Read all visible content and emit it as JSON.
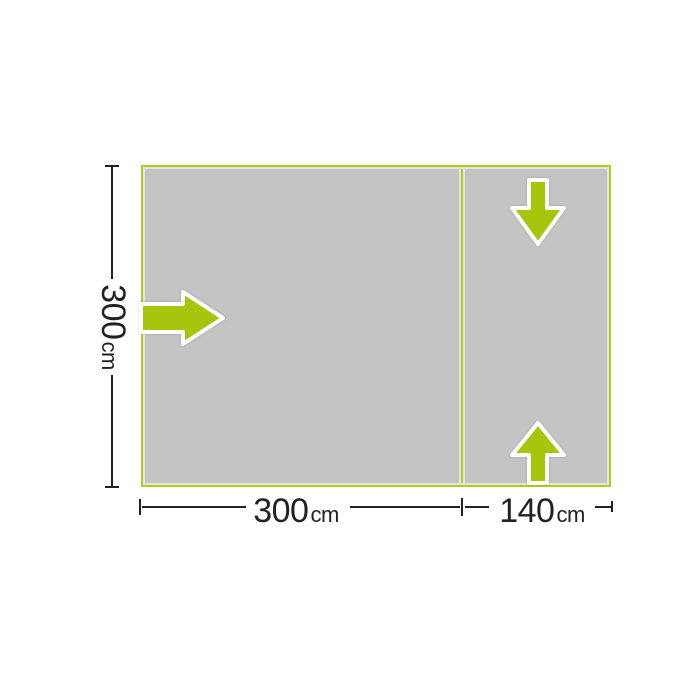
{
  "diagram": {
    "type": "floorplan",
    "description": "Awning footprint diagram with main room and annex section",
    "regions": [
      {
        "name": "main-room",
        "width_cm": 300,
        "depth_cm": 300
      },
      {
        "name": "annex",
        "width_cm": 140,
        "depth_cm": 300
      }
    ],
    "arrows": [
      {
        "icon": "arrow-right-icon",
        "meaning": "side entrance into main room",
        "direction": "right"
      },
      {
        "icon": "arrow-down-icon",
        "meaning": "annex top entrance",
        "direction": "down"
      },
      {
        "icon": "arrow-up-icon",
        "meaning": "annex bottom entrance",
        "direction": "up"
      }
    ]
  },
  "dimensions": {
    "height": {
      "value": "300",
      "unit": "cm"
    },
    "main_width": {
      "value": "300",
      "unit": "cm"
    },
    "annex_width": {
      "value": "140",
      "unit": "cm"
    }
  },
  "colors": {
    "outline_green": "#b3cc20",
    "arrow_green": "#a6c60e",
    "floor_gray": "#c3c4c3",
    "inner_edge": "#e4e5e2",
    "line_dark": "#222222",
    "background": "#ffffff"
  }
}
